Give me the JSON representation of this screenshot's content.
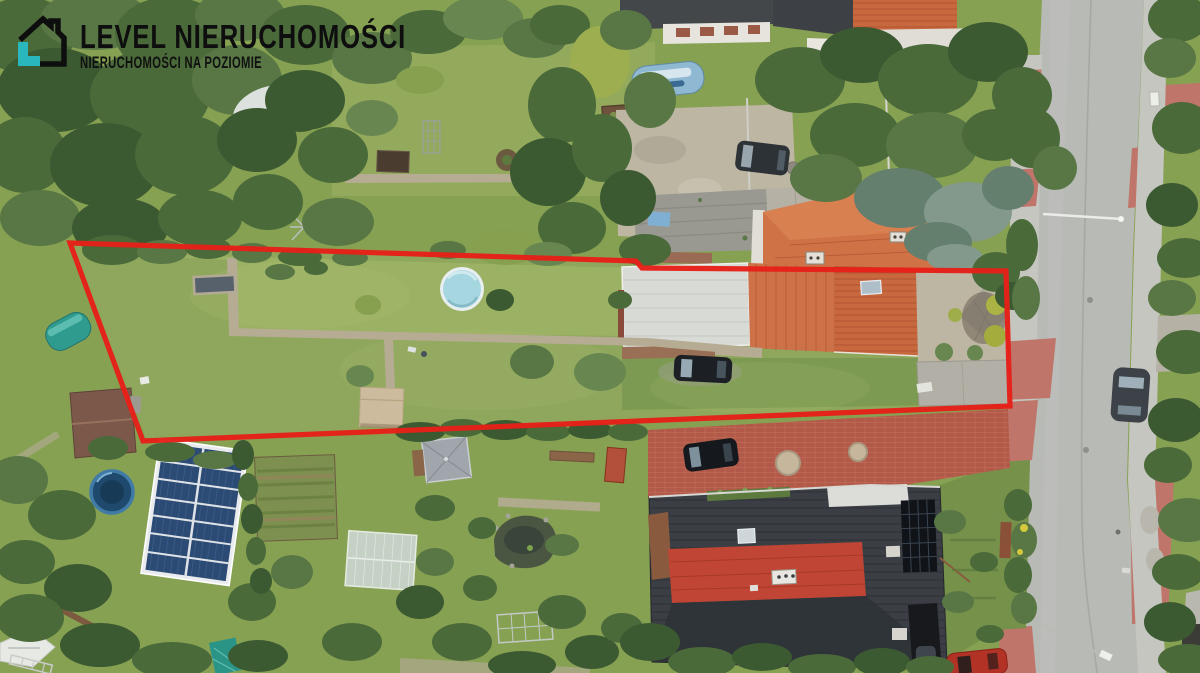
{
  "logo": {
    "title": "LEVEL NIERUCHOMOŚCI",
    "subtitle": "NIERUCHOMOŚCI NA POZIOMIE",
    "icon": "house-logo-icon",
    "colors": {
      "text": "#0e0e0e",
      "accent_teal": "#29b7bd"
    }
  },
  "annotation": {
    "plot_boundary_color": "#e62019",
    "plot_boundary_points": "70,243 636,261 642,268 1006,271 1010,406 143,441",
    "plot_boundary_meaning": "outline of listed parcel"
  },
  "scene": {
    "type": "aerial-drone-photo",
    "description": "Top-down drone photograph of a long narrow garden parcel outlined in red, flanked by neighbouring allotment gardens, an orange tiled-roof house with silver outbuilding, a graphite-roof house with red roof section and rooftop solar panels, garden sheds, a round pool, a large ground solar array, greenhouses, parked cars and a street with red paved walkways on the right.",
    "features": [
      "red plot boundary",
      "garden lawns",
      "round swimming pool",
      "stone garden paths",
      "orange tiled roof house",
      "weathered barn roof with blue tarp",
      "silver metal roof outbuilding",
      "gravel courtyard with yellow shrubs",
      "street with centre seam",
      "red paver sidewalks",
      "street lamps",
      "parked dark SUV on slabs",
      "parked black car on lawn",
      "parked black car on brick driveway",
      "parked grey car on street",
      "parked red car",
      "blue covered boat",
      "ground solar panel array",
      "blue trampoline",
      "brown garden shed",
      "tan garden shed",
      "grey pavilion",
      "greenhouse",
      "garden pond",
      "vegetable beds",
      "graphite roof house with red section and roof solar panels",
      "red brick driveway",
      "hedges and trees",
      "teal water barrel",
      "white boat in corner"
    ],
    "palette": {
      "grass": "#87a153",
      "lawn_light": "#9cb264",
      "tree_dark": "#3c5a31",
      "road": "#b8bab6",
      "sidewalk_red": "#bf7569",
      "roof_orange": "#c8683e",
      "roof_graphite": "#3b3f45",
      "roof_red_section": "#c14534",
      "roof_silver": "#d8dad6",
      "solar_blue": "#2b4a74",
      "pool_blue": "#a6d7e1",
      "brick_red": "#b15a49",
      "gravel": "#bdb6a3"
    }
  }
}
